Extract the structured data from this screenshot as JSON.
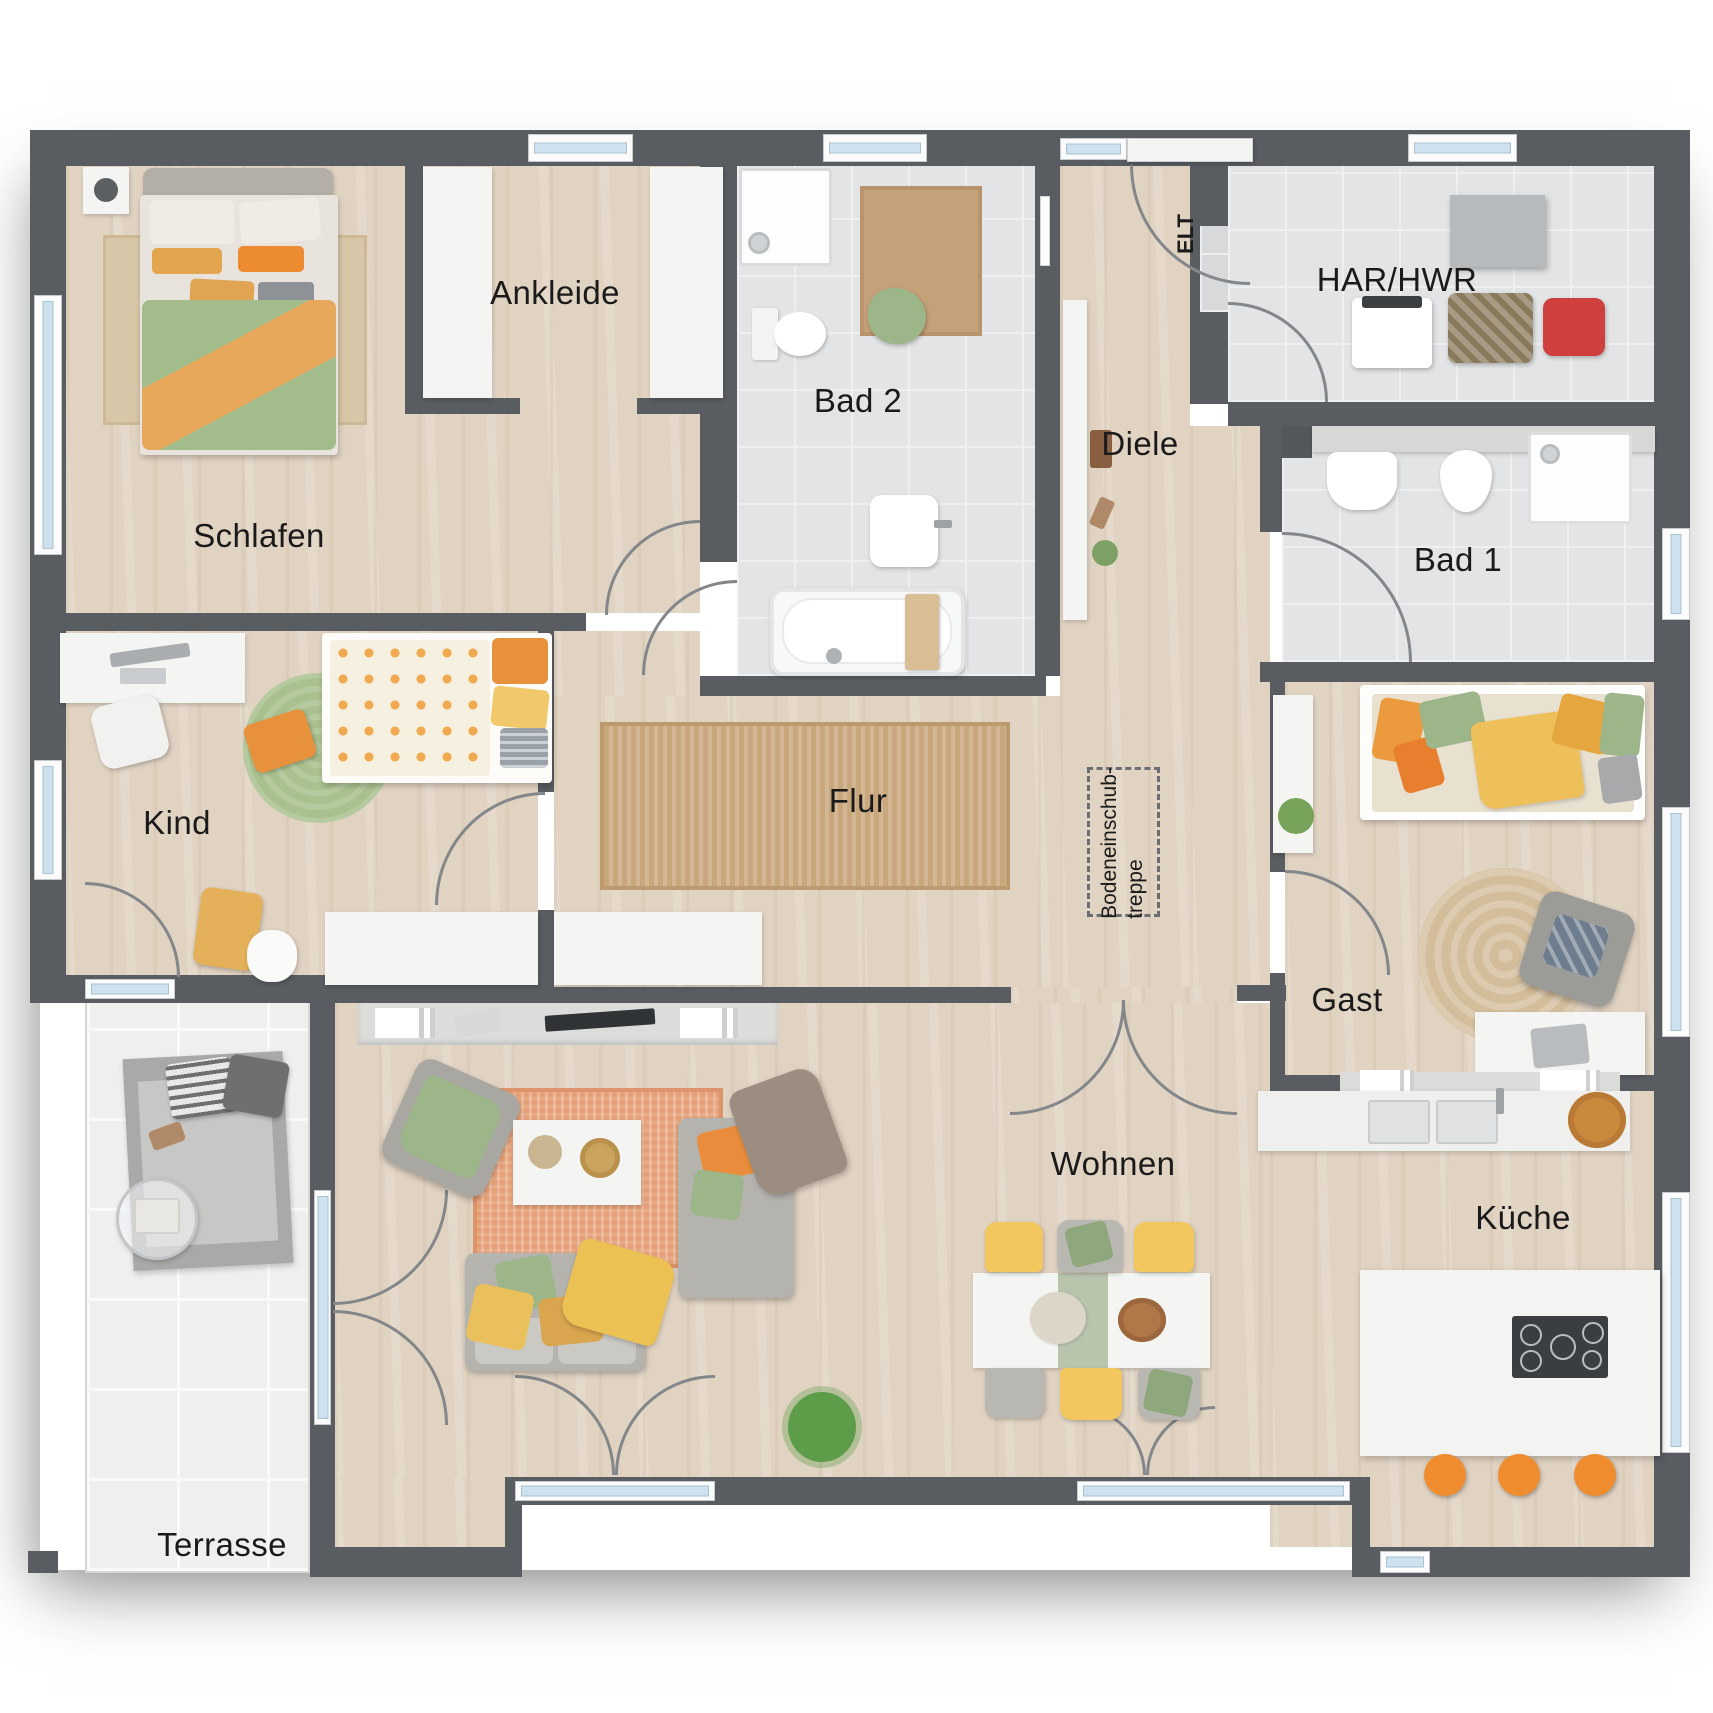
{
  "rooms": {
    "schlafen": {
      "label": "Schlafen"
    },
    "ankleide": {
      "label": "Ankleide"
    },
    "bad2": {
      "label": "Bad 2"
    },
    "diele": {
      "label": "Diele"
    },
    "elt": {
      "label": "ELT"
    },
    "har_hwr": {
      "label": "HAR/HWR"
    },
    "bad1": {
      "label": "Bad 1"
    },
    "kind": {
      "label": "Kind"
    },
    "flur": {
      "label": "Flur"
    },
    "attic": {
      "line1": "Bodeneinschub-",
      "line2": "treppe"
    },
    "gast": {
      "label": "Gast"
    },
    "wohnen": {
      "label": "Wohnen"
    },
    "kueche": {
      "label": "Küche"
    },
    "terrasse": {
      "label": "Terrasse"
    }
  },
  "colors": {
    "wall": "#595d61",
    "wood_floor": "#e1d3c2",
    "tile_floor": "#e2e4e6",
    "terrace_floor": "#efefef",
    "window_glass": "#cde2ee",
    "accent_orange": "#ec9a3e",
    "accent_green": "#a3bc8c",
    "rug_jute": "#c9a77c",
    "rug_living": "#e5a078",
    "label_text": "#1a1a1a"
  }
}
